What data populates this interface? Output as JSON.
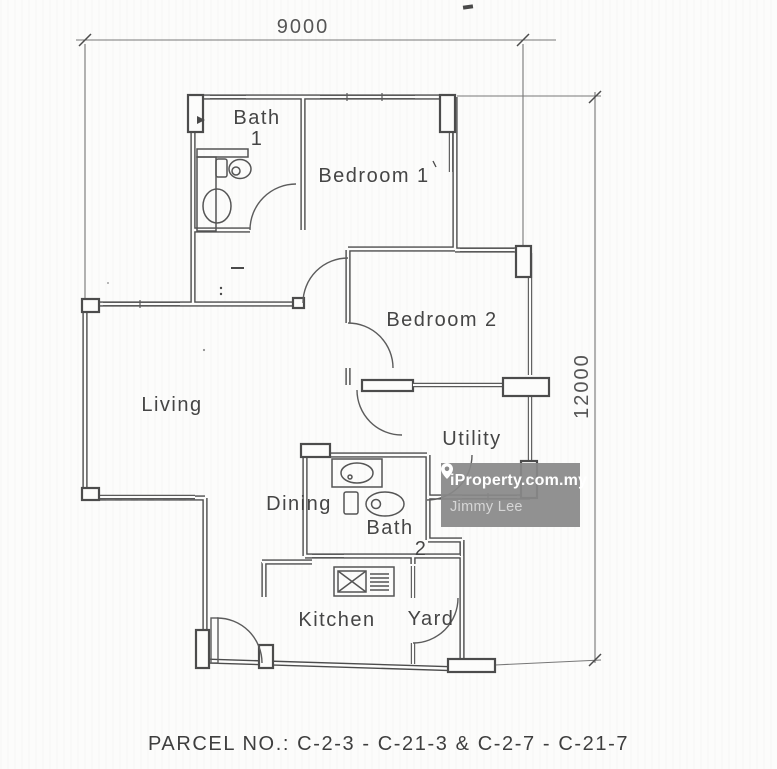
{
  "colors": {
    "paper": "#fcfcfb",
    "wall_line": "#4c4c4c",
    "text": "#454545",
    "watermark_bg": "#898989",
    "watermark_brand": "#ffffff",
    "watermark_agent": "#d6d6d6"
  },
  "dimensions": {
    "width_label": "9000",
    "height_label": "12000"
  },
  "rooms": {
    "bath1": {
      "line1": "Bath",
      "line2": "1"
    },
    "bedroom1": "Bedroom 1",
    "bedroom2": "Bedroom 2",
    "living": "Living",
    "dining": "Dining",
    "utility": "Utility",
    "bath2": {
      "line1": "Bath",
      "line2": "2"
    },
    "kitchen": "Kitchen",
    "yard": "Yard"
  },
  "watermark": {
    "brand": "iProperty.com.my",
    "agent": "Jimmy Lee",
    "icon": "location-pin"
  },
  "footer": {
    "parcel_label": "PARCEL NO.: C-2-3 - C-21-3 & C-2-7 - C-21-7"
  }
}
